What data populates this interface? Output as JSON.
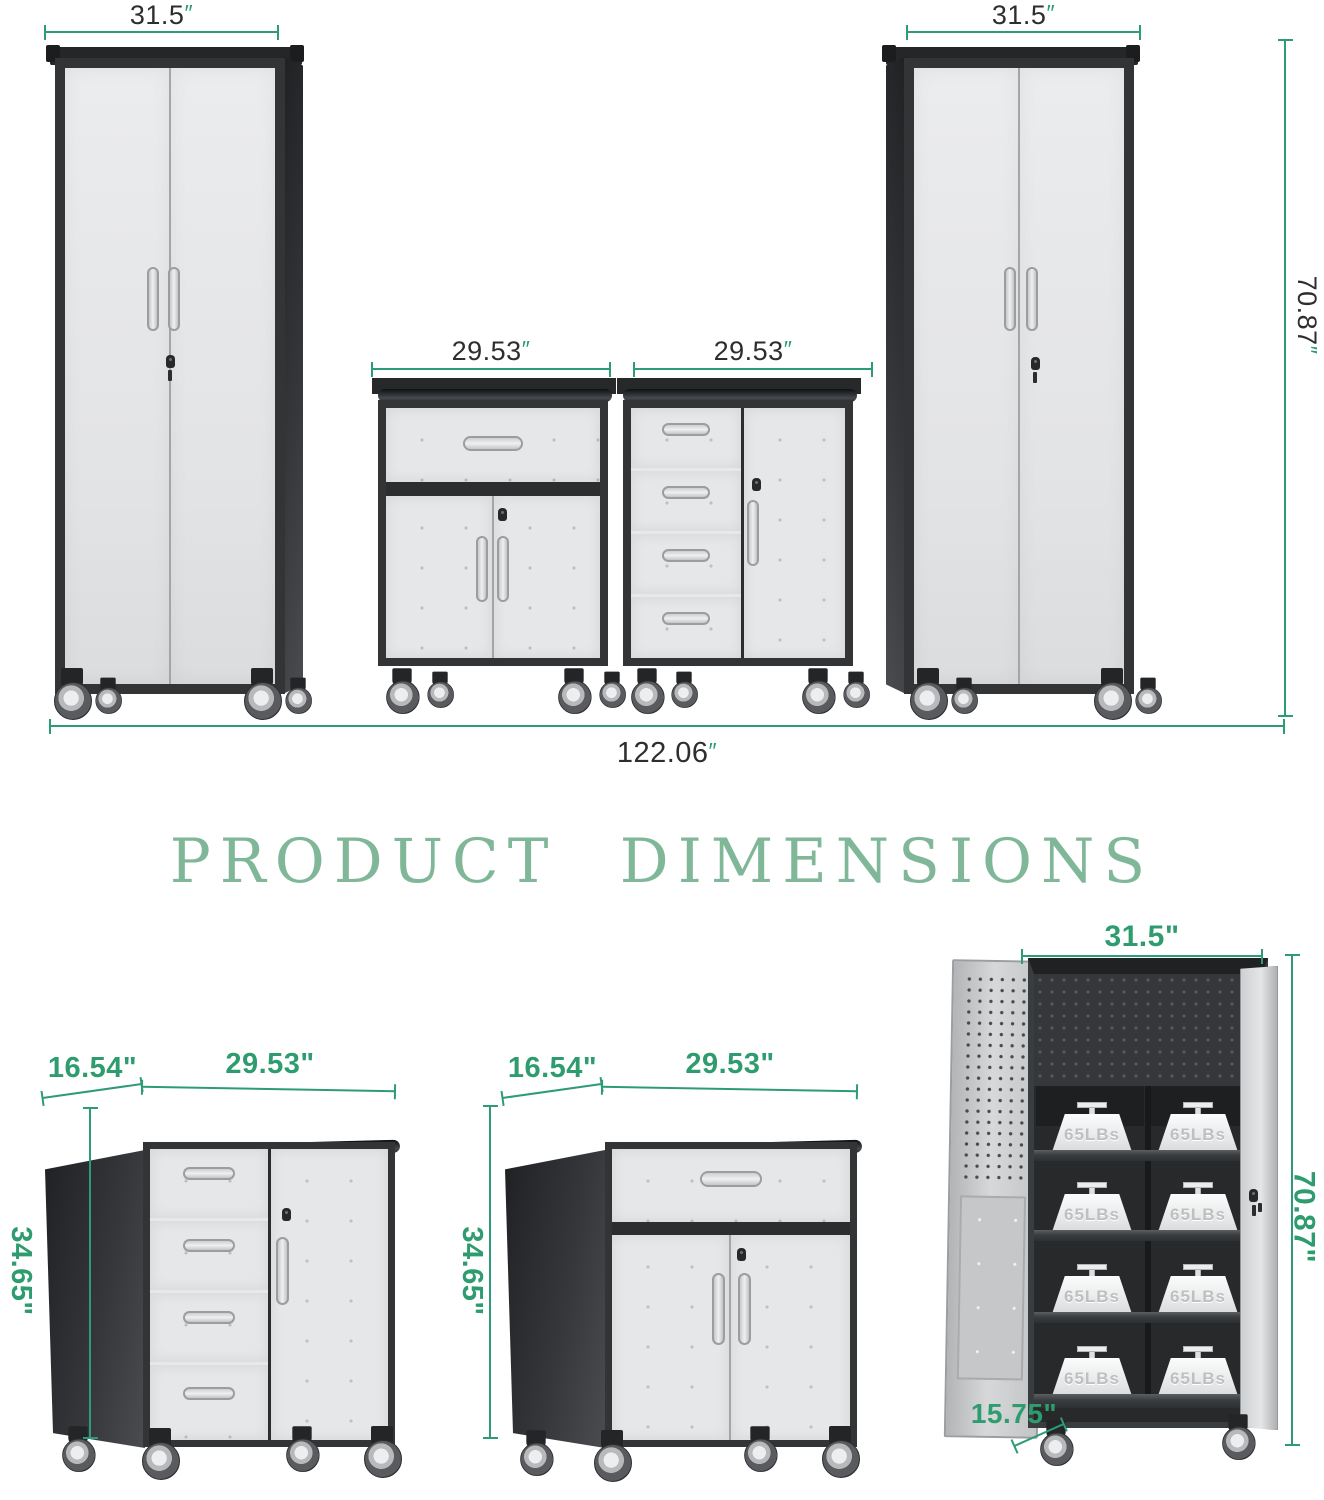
{
  "title": "PRODUCT DIMENSIONS",
  "colors": {
    "dim_line": "#2e9b78",
    "label_green": "#2f9c6f",
    "title_green": "#80b798",
    "label_dark": "#2e2e2e",
    "frame": "#323436"
  },
  "top_row": {
    "unit": "″",
    "tall_left_width": "31.5",
    "mid_left_width": "29.53",
    "mid_right_width": "29.53",
    "tall_right_width": "31.5",
    "right_height": "70.87",
    "total_width": "122.06"
  },
  "bottom_row": {
    "drawer_cabinet": {
      "depth": "16.54\"",
      "width": "29.53\"",
      "height": "34.65\""
    },
    "door_cabinet": {
      "depth": "16.54\"",
      "width": "29.53\"",
      "height": "34.65\""
    },
    "open_cabinet": {
      "width": "31.5\"",
      "height": "70.87\"",
      "depth": "15.75\"",
      "weight_label": "65LBs"
    }
  }
}
